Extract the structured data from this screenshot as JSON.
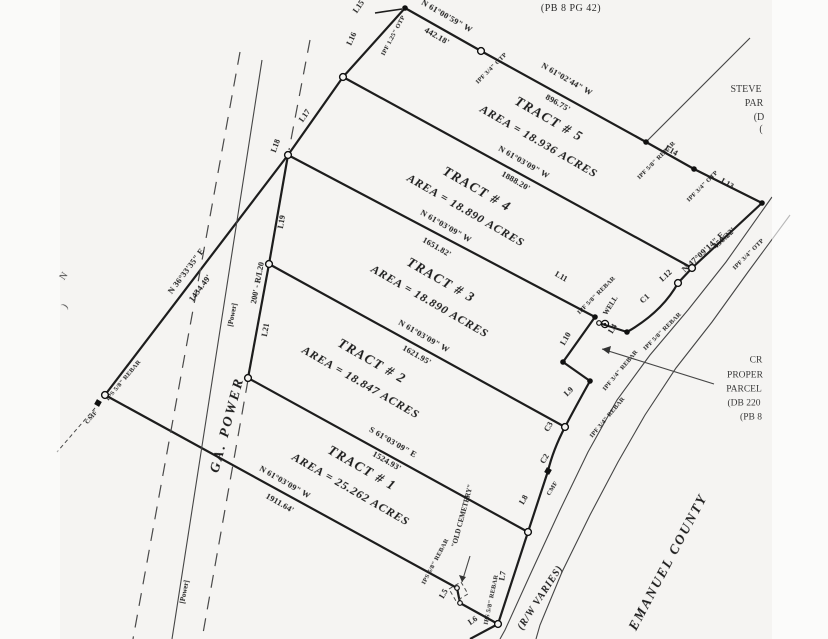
{
  "plat": {
    "reference": "(PB 8 PG 42)"
  },
  "tracts": [
    {
      "name": "TRACT # 1",
      "area": "AREA = 25.262 ACRES"
    },
    {
      "name": "TRACT # 2",
      "area": "AREA = 18.847 ACRES"
    },
    {
      "name": "TRACT # 3",
      "area": "AREA = 18.890 ACRES"
    },
    {
      "name": "TRACT # 4",
      "area": "AREA = 18.890 ACRES"
    },
    {
      "name": "TRACT # 5",
      "area": "AREA = 18.936 ACRES"
    }
  ],
  "bearings": {
    "north_a": {
      "bearing": "N 61°00'59\" W",
      "distance": "442.18'"
    },
    "north_b": {
      "bearing": "N 61°02'44\" W",
      "distance": "896.75'"
    },
    "tract45": {
      "bearing": "N 61°03'09\" W",
      "distance": "1888.20'"
    },
    "tract34": {
      "bearing": "N 61°03'09\" W",
      "distance": "1651.82'"
    },
    "tract23": {
      "bearing": "N 61°03'09\" W",
      "distance": "1621.95'"
    },
    "tract12": {
      "bearing": "S 61°03'09\" E",
      "distance": "1524.93'"
    },
    "south": {
      "bearing": "N 61°03'09\" W",
      "distance": "1911.64'"
    },
    "west": {
      "bearing": "N 36°33'35\" E",
      "distance": "1434.49'"
    },
    "northeast": {
      "bearing": "N 47°09'14\" E",
      "distance": "450.22'"
    }
  },
  "lines": {
    "l4": "L4",
    "l5": "L5",
    "l6": "L6",
    "l7": "L7",
    "l8": "L8",
    "l9": "L9",
    "l10": "L10",
    "l11": "L11",
    "l12": "L12",
    "l13": "L13",
    "l14": "L14",
    "l15": "L15",
    "l16": "L16",
    "l17": "L17",
    "l18": "L18",
    "l19": "L19",
    "l21": "L21",
    "r_l20": "200'  -  R/L20"
  },
  "curves": {
    "c1": "C1",
    "c2": "C2",
    "c3": "C3"
  },
  "monuments": {
    "m1": "IPF 1.25\" OTP",
    "m2": "IPF 3/4\" OTP",
    "m3": "IPF 5/8\" REBAR",
    "m4": "IPF 3/4\" OTP",
    "m5": "IPF 3/4\" OTP",
    "m6": "IPF 5/8\" REBAR",
    "m7": "IPF 5/8\" REBAR",
    "m8": "IPF 3/4\" REBAR",
    "m9": "IPF 3/4\" REBAR",
    "m10": "IPS 5/8\" REBAR",
    "m11": "CMF",
    "m12": "CMF",
    "m13": "IPS 5/8\" REBAR",
    "m14": "IPS 5/8\" REBAR"
  },
  "features": {
    "well": "WELL",
    "old_cemetery": "\"OLD CEMETERY\"",
    "ga_power": "GA. POWER",
    "power_bracket_1": "[Power]",
    "power_bracket_2": "[Power]",
    "rw_varies": "(R/W VARIES)",
    "county": "EMANUEL COUNTY"
  },
  "neighbors": {
    "stevens_lines": [
      "STEVE",
      "PAR",
      "(D",
      "("
    ],
    "cr_lines": [
      "CR",
      "PROPER",
      "PARCEL",
      "(DB 220",
      "(PB 8"
    ],
    "west_fragments": [
      "N",
      ")"
    ]
  }
}
